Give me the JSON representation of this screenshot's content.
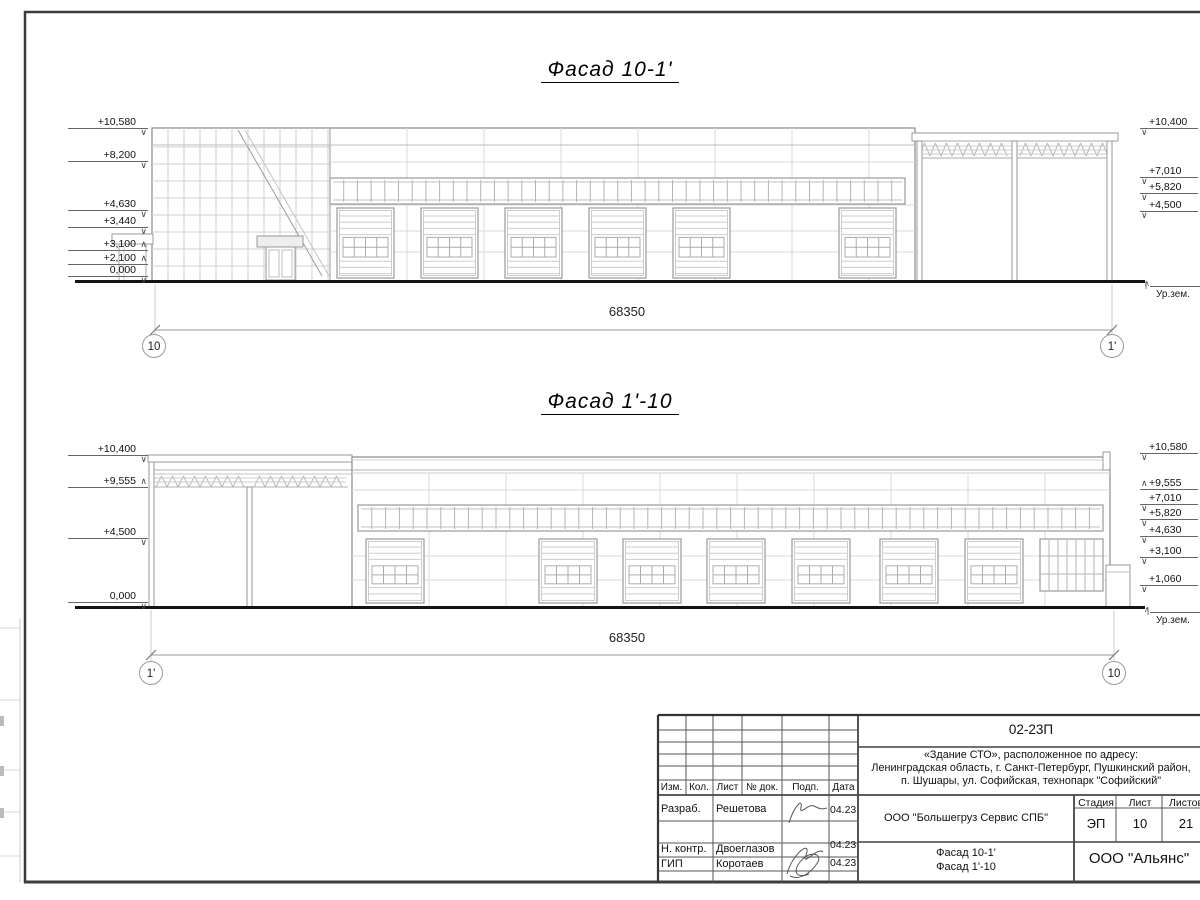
{
  "facades": [
    {
      "title": "Фасад 10-1'",
      "dimension": "68350",
      "axis_left": "10",
      "axis_right": "1'",
      "ground_label": "Ур.зем.",
      "left_marks": [
        {
          "label": "+10,580",
          "y": 116,
          "sym": "down"
        },
        {
          "label": "+8,200",
          "y": 149,
          "sym": "down"
        },
        {
          "label": "+4,630",
          "y": 198,
          "sym": "down"
        },
        {
          "label": "+3,440",
          "y": 215,
          "sym": "down"
        },
        {
          "label": "+3,100",
          "y": 238,
          "sym": "up"
        },
        {
          "label": "+2,100",
          "y": 252,
          "sym": "up"
        },
        {
          "label": "0,000",
          "y": 264,
          "sym": "down"
        }
      ],
      "right_marks": [
        {
          "label": "+10,400",
          "y": 116,
          "sym": "down"
        },
        {
          "label": "+7,010",
          "y": 165,
          "sym": "down"
        },
        {
          "label": "+5,820",
          "y": 181,
          "sym": "down"
        },
        {
          "label": "+4,500",
          "y": 199,
          "sym": "down"
        }
      ]
    },
    {
      "title": "Фасад 1'-10",
      "dimension": "68350",
      "axis_left": "1'",
      "axis_right": "10",
      "ground_label": "Ур.зем.",
      "left_marks": [
        {
          "label": "+10,400",
          "y": 443,
          "sym": "down"
        },
        {
          "label": "+9,555",
          "y": 475,
          "sym": "up"
        },
        {
          "label": "+4,500",
          "y": 526,
          "sym": "down"
        },
        {
          "label": "0,000",
          "y": 590,
          "sym": "down"
        }
      ],
      "right_marks": [
        {
          "label": "+10,580",
          "y": 441,
          "sym": "down"
        },
        {
          "label": "+9,555",
          "y": 477,
          "sym": "up"
        },
        {
          "label": "+7,010",
          "y": 492,
          "sym": "down"
        },
        {
          "label": "+5,820",
          "y": 507,
          "sym": "down"
        },
        {
          "label": "+4,630",
          "y": 524,
          "sym": "down"
        },
        {
          "label": "+3,100",
          "y": 545,
          "sym": "down"
        },
        {
          "label": "+1,060",
          "y": 573,
          "sym": "down"
        }
      ]
    }
  ],
  "titleblock": {
    "code": "02-23П",
    "project_lines": [
      "«Здание СТО», расположенное по адресу:",
      "Ленинградская область, г. Санкт-Петербург, Пушкинский район,",
      "п. Шушары, ул. Софийская, технопарк \"Софийский\""
    ],
    "columns": [
      "Изм.",
      "Кол.",
      "Лист",
      "№ док.",
      "Подп.",
      "Дата"
    ],
    "rows": [
      {
        "role": "Разраб.",
        "name": "Решетова",
        "date": "04.23"
      },
      {
        "role": "Н. контр.",
        "name": "Двоеглазов",
        "date": "04.23"
      },
      {
        "role": "ГИП",
        "name": "Коротаев",
        "date": "04.23"
      }
    ],
    "client": "ООО \"Большегруз Сервис СПБ\"",
    "stage_label": "Стадия",
    "stage": "ЭП",
    "sheet_label": "Лист",
    "sheet": "10",
    "sheets_label": "Листов",
    "sheets": "21",
    "drawing_titles": [
      "Фасад 10-1'",
      "Фасад 1'-10"
    ],
    "org": "ООО \"Альянс\""
  }
}
